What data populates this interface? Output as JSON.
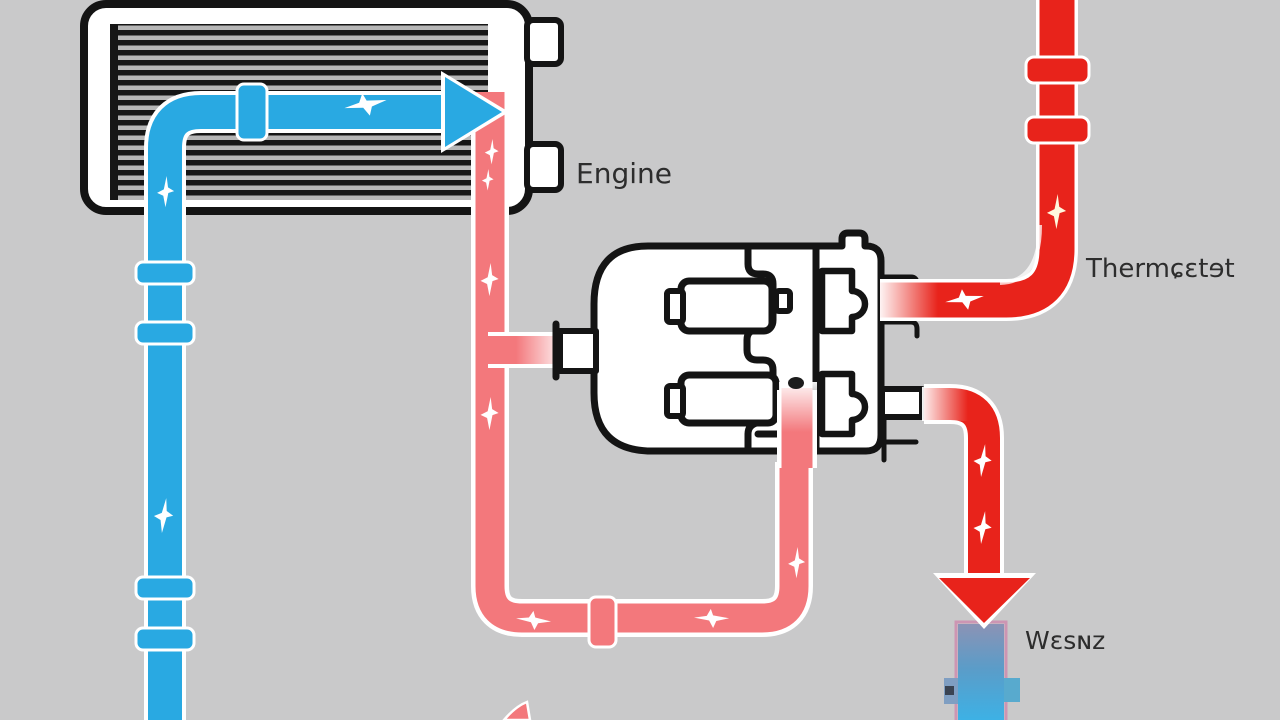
{
  "diagram": {
    "type": "engine-cooling-system-schematic",
    "labels": {
      "engine": "Engine",
      "thermostat": "Thermɕɛtɘt",
      "pump": "Wɛsɴz"
    },
    "colors": {
      "background": "#c9c9ca",
      "cold_coolant_pipe": "#29a9e2",
      "hot_coolant_pipe": "#e8231b",
      "warm_coolant_pipe": "#f3787c",
      "outline": "#141414",
      "radiator_fin": "#161616",
      "radiator_fin_gap": "#b6b6b6",
      "label_text": "#2d2d2d",
      "pump_top": "#8b93b5",
      "pump_bottom": "#3cb2e6"
    },
    "components": [
      "radiator",
      "engine-block",
      "thermostat-pipe",
      "water-pump",
      "coolant-flow-arrows"
    ]
  }
}
